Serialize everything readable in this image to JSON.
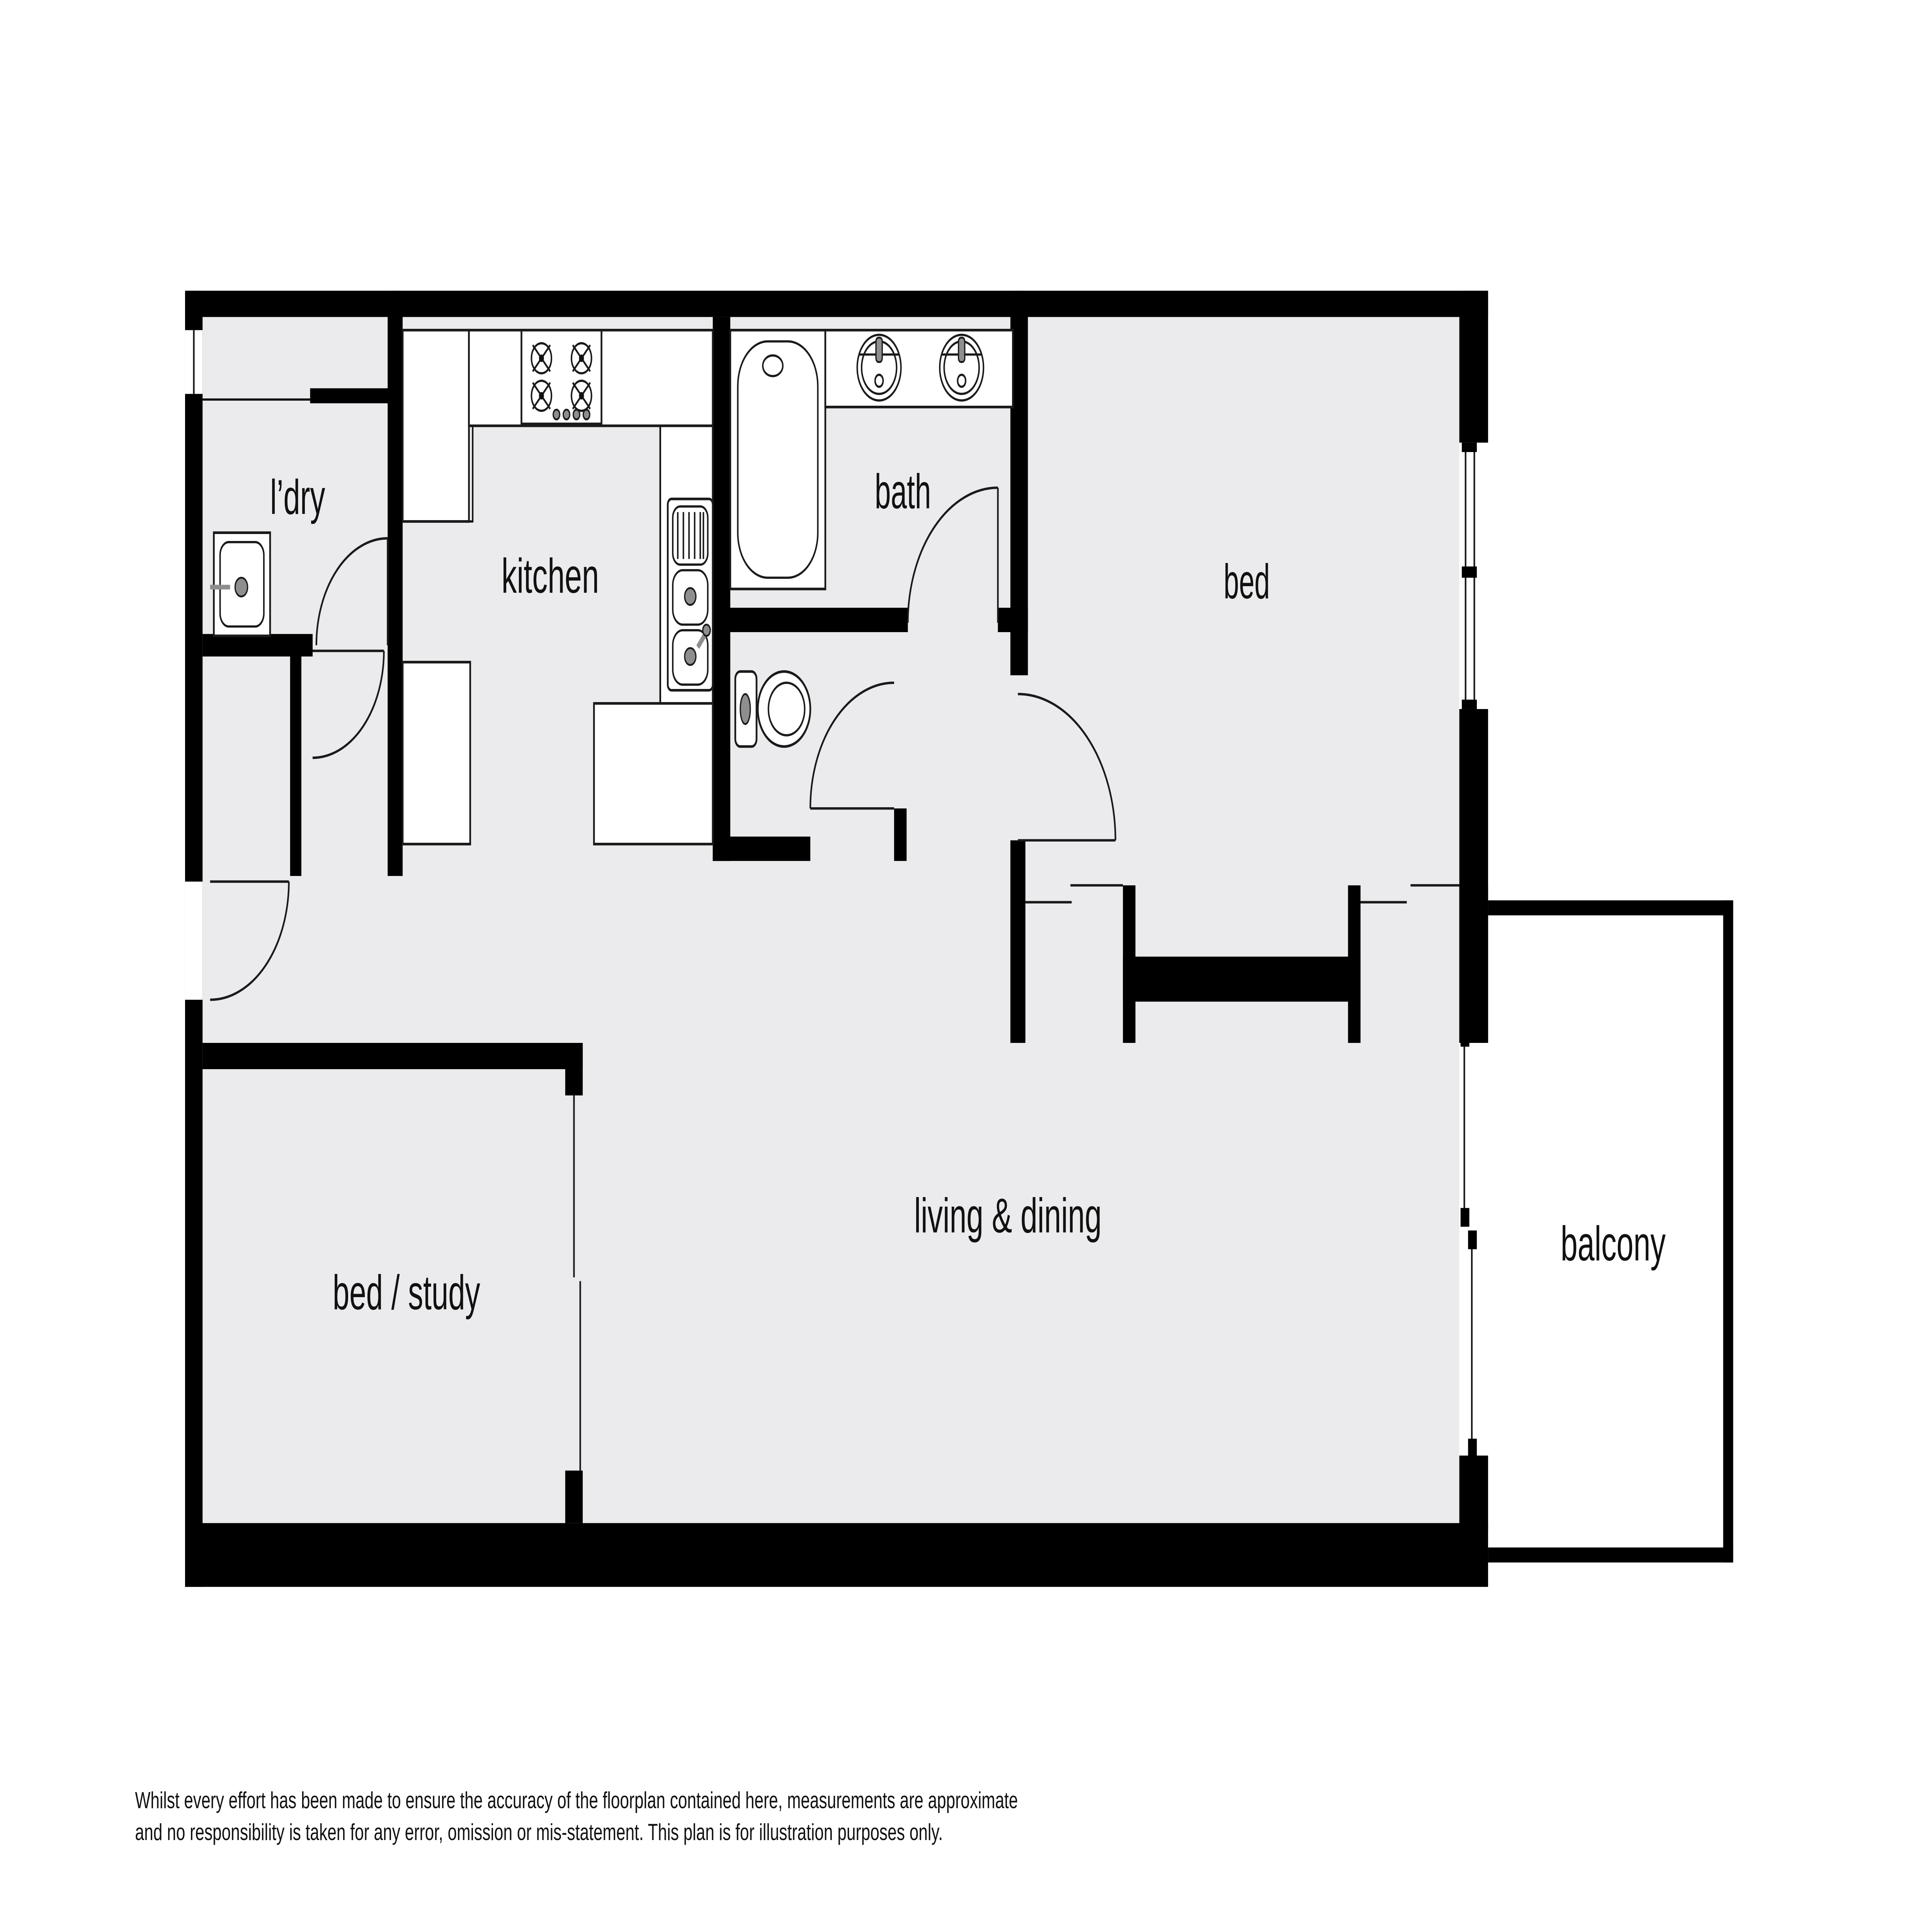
{
  "plan": {
    "type": "apartment-floorplan",
    "rooms": {
      "laundry": {
        "label": "l’dry"
      },
      "kitchen": {
        "label": "kitchen"
      },
      "bath": {
        "label": "bath"
      },
      "bed": {
        "label": "bed"
      },
      "living_dining": {
        "label": "living & dining"
      },
      "bed_study": {
        "label": "bed / study"
      },
      "balcony": {
        "label": "balcony"
      }
    },
    "disclaimer": {
      "line1": "Whilst every effort has been made to ensure the accuracy of the floorplan contained here, measurements are approximate",
      "line2": "and no responsibility is taken for any error, omission or mis-statement. This plan is for illustration purposes only."
    },
    "colors": {
      "background": "#ffffff",
      "floor": "#ebebed",
      "wall": "#000000",
      "fixture_outline": "#1a1a1a",
      "metal_gray": "#8e8e8e",
      "label_text": "#111111"
    },
    "fixtures": [
      "bathtub",
      "vanity-basin-left",
      "vanity-basin-right",
      "toilet",
      "kitchen-double-sink",
      "laundry-sink",
      "stove-cooktop",
      "swing-door",
      "sliding-door",
      "window"
    ]
  }
}
